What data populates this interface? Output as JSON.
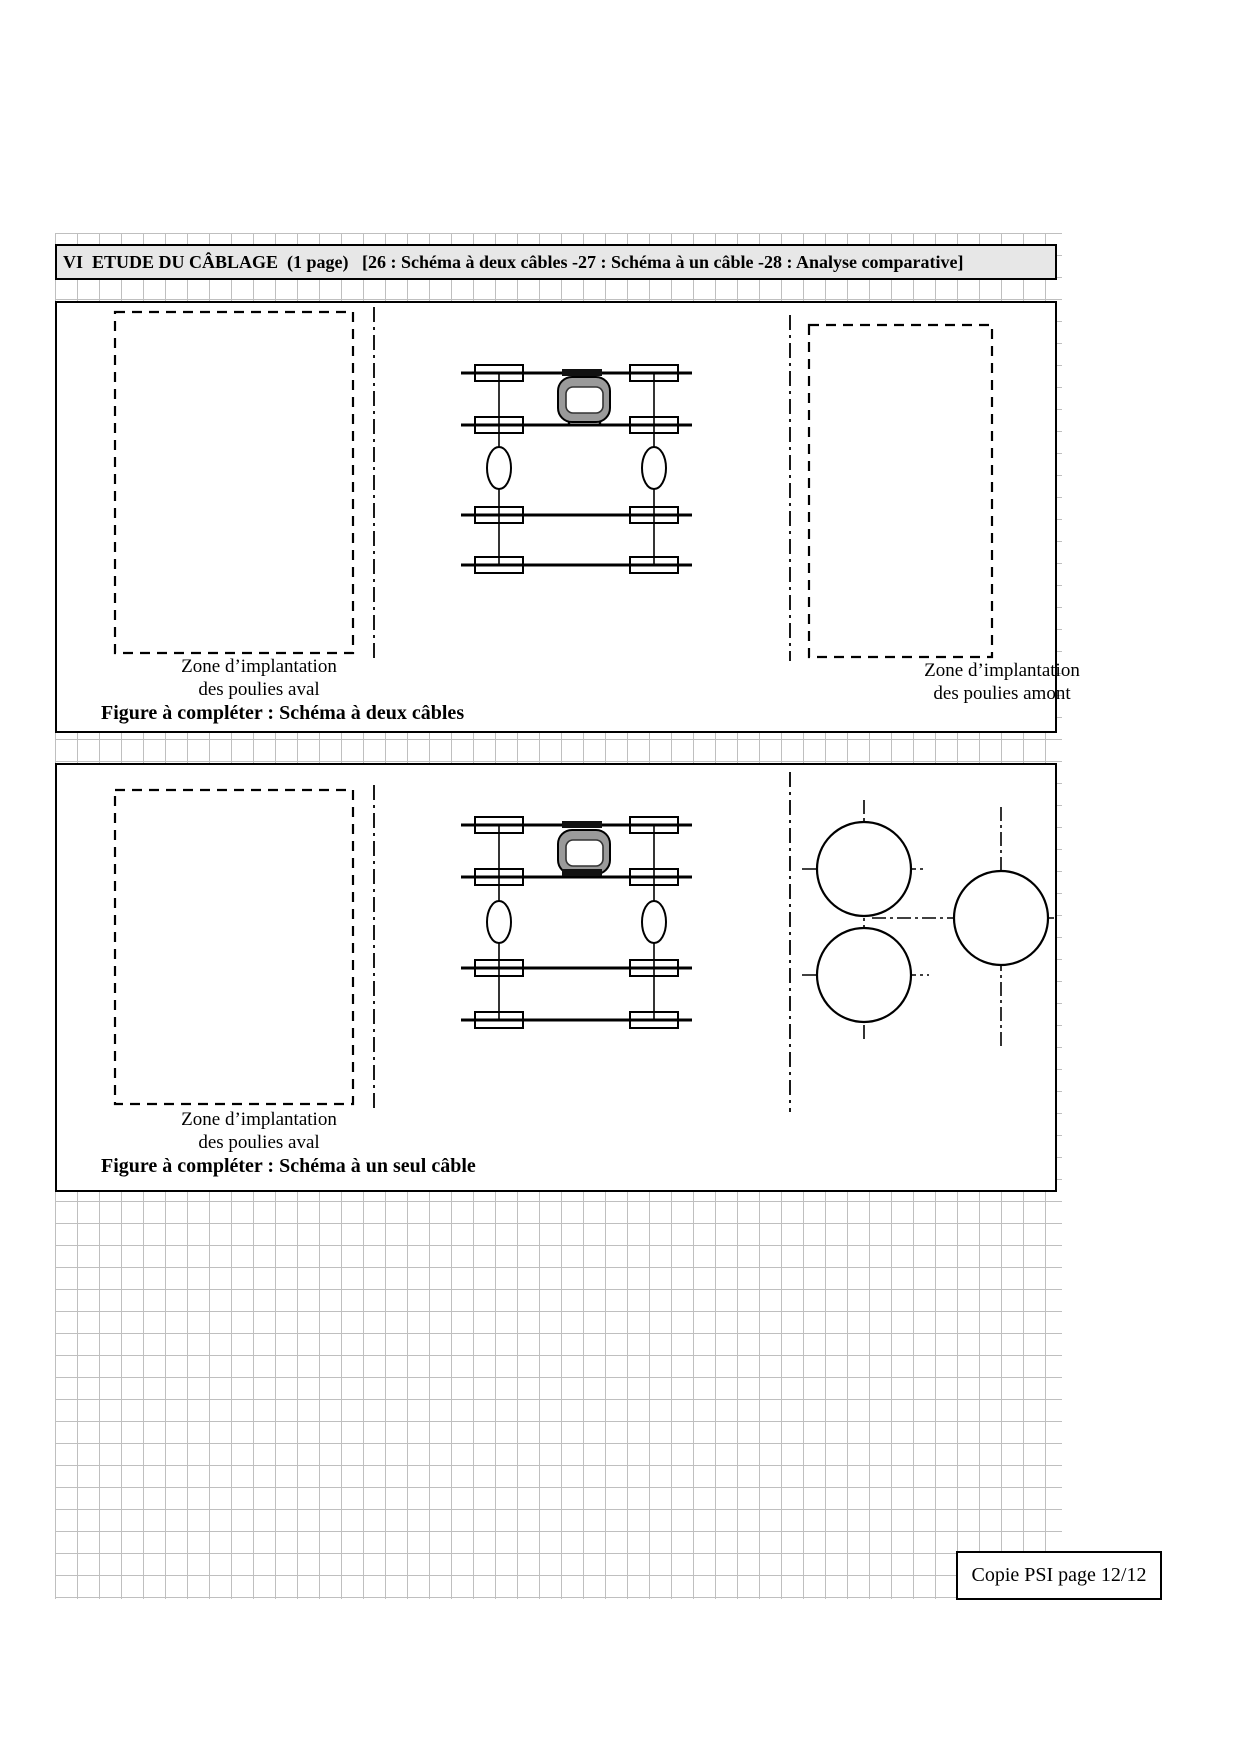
{
  "colors": {
    "grid": "#bfbfbf",
    "title_bar_bg": "#e7e7e7",
    "ink": "#000000",
    "motor_gray": "#9a9a9a"
  },
  "title_bar": {
    "text": "VI  ETUDE DU CÂBLAGE  (1 page)   [26 : Schéma à deux câbles -27 : Schéma à un câble -28 : Analyse comparative]"
  },
  "figure1": {
    "zone_left": {
      "line1": "Zone d’implantation",
      "line2": "des poulies aval"
    },
    "zone_right": {
      "line1": "Zone d’implantation",
      "line2": "des poulies amont"
    },
    "caption": "Figure à compléter : Schéma à deux câbles"
  },
  "figure2": {
    "zone_left": {
      "line1": "Zone d’implantation",
      "line2": "des poulies aval"
    },
    "caption": "Figure à compléter : Schéma à un seul câble"
  },
  "footer": {
    "text": "Copie PSI page 12/12"
  }
}
